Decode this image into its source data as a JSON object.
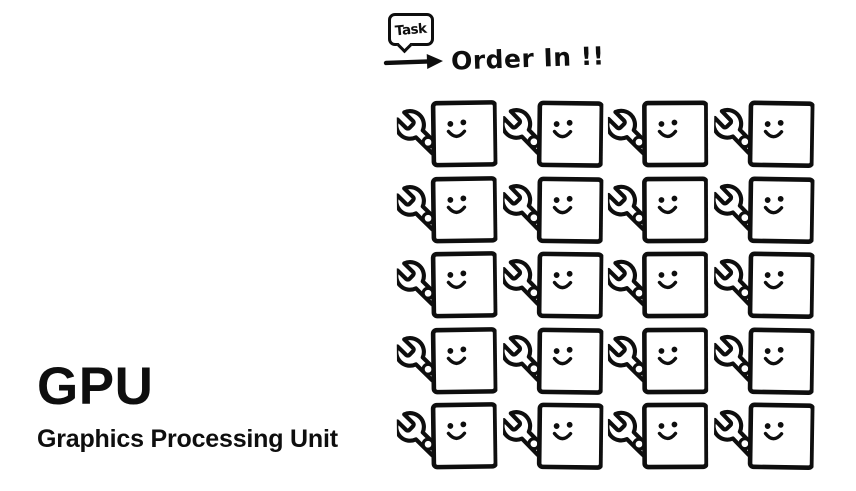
{
  "page": {
    "background": "#ffffff",
    "ink": "#0e0e0e"
  },
  "brand": {
    "acronym": "GPU",
    "name": "Graphics Processing Unit"
  },
  "annotation": {
    "bubble_label": "Task",
    "caption": "Order In !!"
  },
  "worker_grid": {
    "rows": 5,
    "columns": 4,
    "total_units": 20,
    "unit_description": "square core with smiley face holding a wrench"
  },
  "icons": {
    "speech_bubble": "task-speech-bubble",
    "arrow": "arrow-right-icon",
    "wrench": "wrench-icon",
    "face": "smiley-face"
  }
}
